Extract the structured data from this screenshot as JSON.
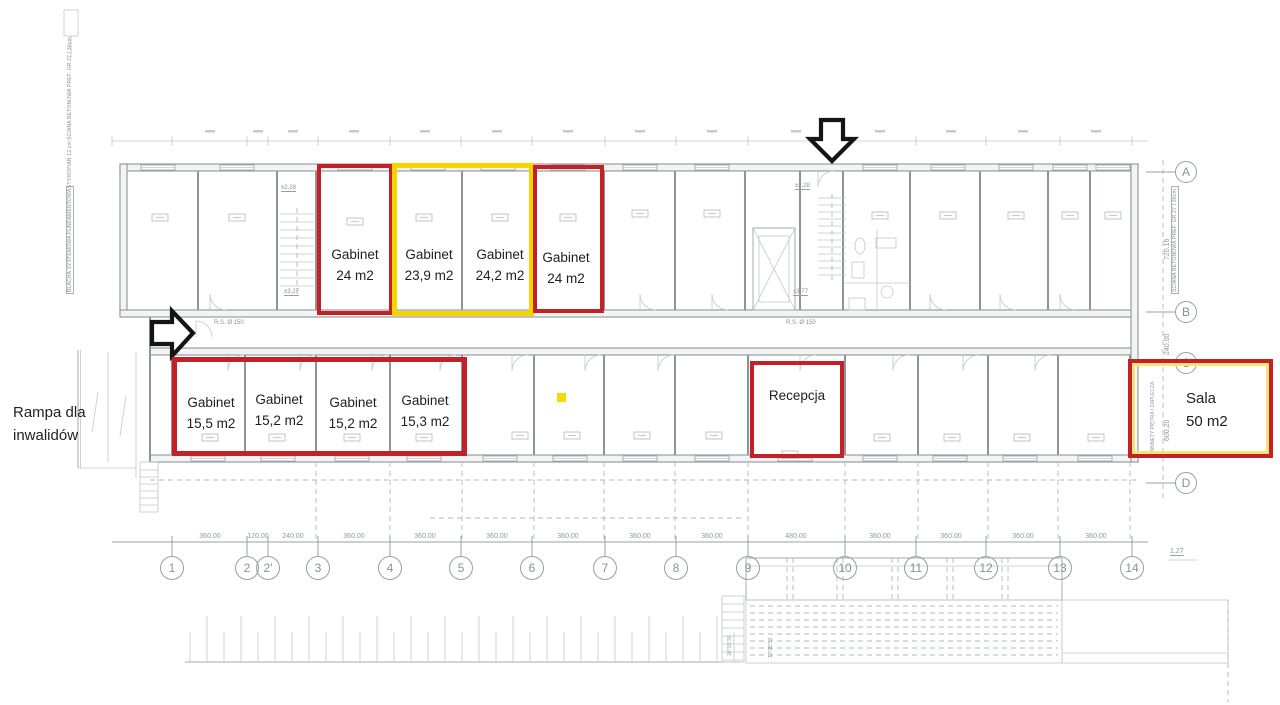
{
  "colors": {
    "highlight_red": "#c42127",
    "highlight_yellow": "#f6d400",
    "arrow_black": "#151515",
    "blueprint_gray": "#9298a0",
    "marker_yellow": "#f4dc00"
  },
  "highlights": {
    "top_rooms": [
      {
        "name": "Gabinet",
        "area": "24 m2",
        "outline": "red"
      },
      {
        "name": "Gabinet",
        "area": "23,9 m2",
        "outline": "yellow"
      },
      {
        "name": "Gabinet",
        "area": "24,2 m2",
        "outline": "yellow"
      },
      {
        "name": "Gabinet",
        "area": "24 m2",
        "outline": "red"
      }
    ],
    "bottom_rooms": [
      {
        "name": "Gabinet",
        "area": "15,5 m2"
      },
      {
        "name": "Gabinet",
        "area": "15,2 m2"
      },
      {
        "name": "Gabinet",
        "area": "15,2 m2"
      },
      {
        "name": "Gabinet",
        "area": "15,3 m2"
      }
    ],
    "reception": {
      "name": "Recepcja"
    },
    "hall": {
      "name": "Sala",
      "area": "50 m2"
    }
  },
  "ramp": {
    "line1": "Rampa dla",
    "line2": "inwalidów"
  },
  "grid": {
    "columns": [
      "1",
      "2",
      "2'",
      "3",
      "4",
      "5",
      "6",
      "7",
      "8",
      "9",
      "10",
      "11",
      "12",
      "13",
      "14"
    ],
    "column_spans": [
      "360.00",
      "120.00",
      "240.00",
      "360.00",
      "360.00",
      "360.00",
      "360.00",
      "360.00",
      "360.00",
      "480.00",
      "360.00",
      "360.00",
      "360.00",
      "360.00"
    ],
    "rows": [
      "A",
      "B",
      "C",
      "D"
    ],
    "row_spans": [
      "720.16",
      "240.00",
      "600.20"
    ],
    "level_mark": "1,27"
  },
  "plan_texts": {
    "pipe_left": "R.S. Ø 150",
    "pipe_center": "R.S. Ø 150",
    "level_a": "±2,28",
    "level_b": "±3,27",
    "level_c": "±2,28",
    "level_d": "±3,77",
    "wall_note_left_1": "BLACHA SYSTEMOWA FUNDAMENTOWA",
    "wall_note_left_2": "STYROPIAN 12 cm",
    "wall_note_left_3": "ŚCIANA BETONOWA PREF. GR.27 I 36cm",
    "wall_note_right": "ŚCIANA BETONOWA PREF. GR.27 I 36cm",
    "hall_side_note": "GABINETY PIĘTRA I ZAPLECZA",
    "terrace_note_1": "10*15*32",
    "terrace_note_2": "36*15*30"
  }
}
